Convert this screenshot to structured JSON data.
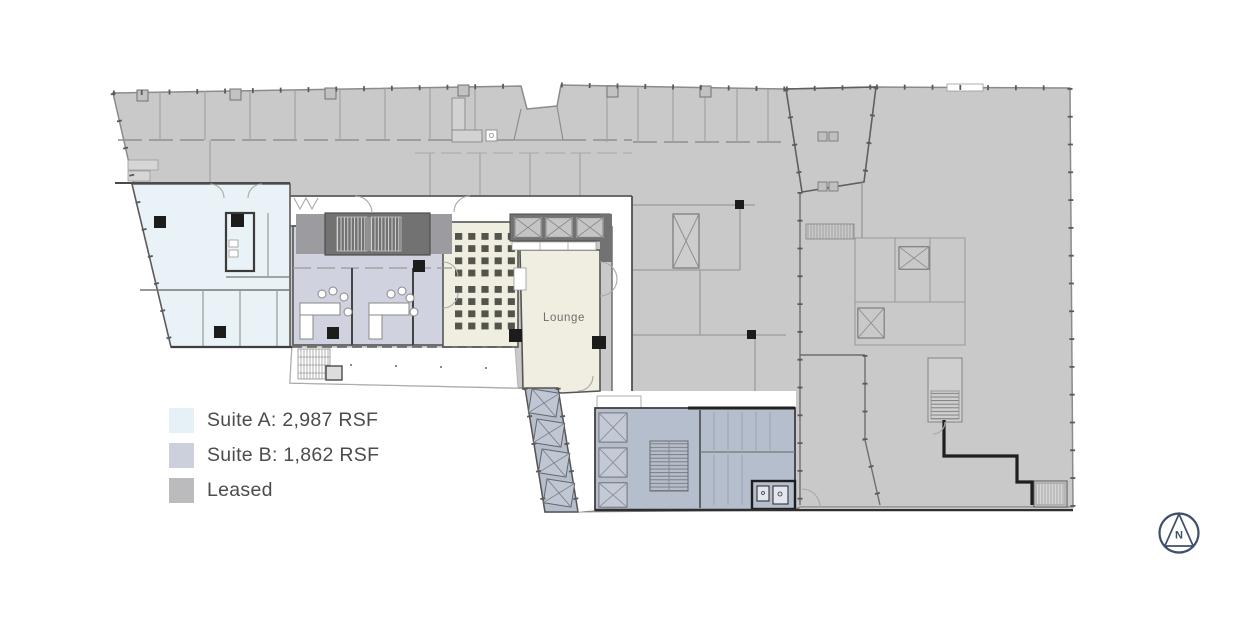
{
  "legend": {
    "items": [
      {
        "id": "suite-a",
        "label": "Suite A: 2,987 RSF",
        "color": "#e6f1f5"
      },
      {
        "id": "suite-b",
        "label": "Suite B: 1,862 RSF",
        "color": "#ccd0dd"
      },
      {
        "id": "leased",
        "label": "Leased",
        "color": "#bbbbbd"
      }
    ]
  },
  "plan": {
    "lounge_label": "Lounge",
    "compass_label": "N",
    "colors": {
      "leased_fill": "#c9c9ca",
      "suite_a_fill": "#e9f2f6",
      "suite_b_fill": "#d0d3df",
      "lounge_fill": "#efeee0",
      "core_fill": "#b5becd",
      "dark_block": "#727272",
      "wall": "#3c3c3c",
      "compass": "#3e4e6b"
    }
  }
}
